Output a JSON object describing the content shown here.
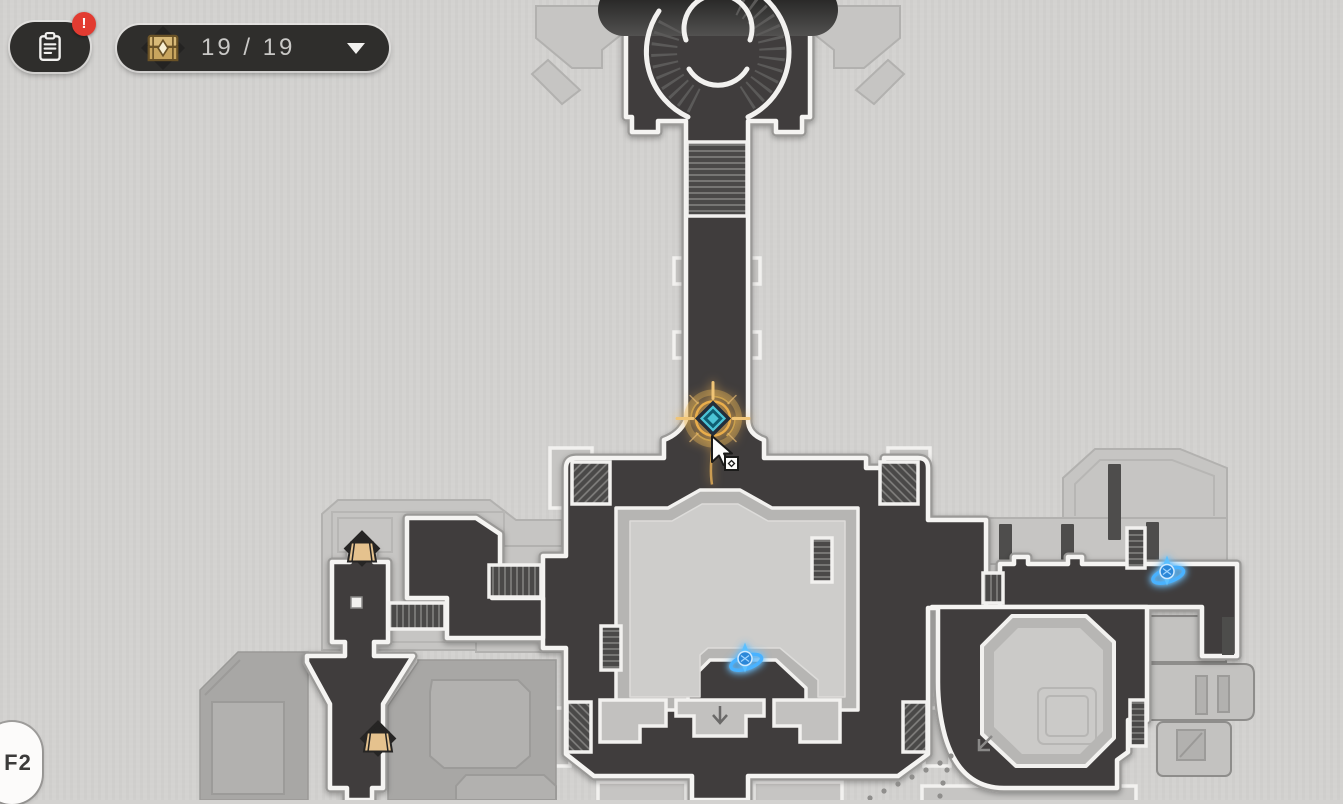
{
  "hud": {
    "tasks_button": {
      "icon": "clipboard-icon",
      "badge": "!"
    },
    "chest_counter": {
      "icon": "treasure-chest-icon",
      "count": "19 / 19",
      "caret_icon": "caret-down-icon"
    },
    "floor_indicator": {
      "label": "F2"
    }
  },
  "map": {
    "markers": [
      {
        "type": "player",
        "name": "player-position-marker",
        "x": 713,
        "y": 421
      },
      {
        "type": "cursor",
        "name": "mouse-cursor",
        "x": 712,
        "y": 437
      },
      {
        "type": "anchor",
        "name": "space-anchor-icon",
        "x": 745,
        "y": 661
      },
      {
        "type": "anchor",
        "name": "space-anchor-icon",
        "x": 1167,
        "y": 574
      },
      {
        "type": "bag",
        "name": "shop-bag-icon",
        "x": 362,
        "y": 551
      },
      {
        "type": "bag",
        "name": "shop-bag-icon",
        "x": 378,
        "y": 741
      }
    ],
    "colors": {
      "background": "#d3d2d0",
      "room_dark": "#3f3e3d",
      "room_border": "#f5f4f2",
      "platform_light": "#c6c5c3",
      "platform_medium": "#a8a7a5",
      "anchor_blue": "#3fa8f5",
      "player_teal": "#4cc4d6",
      "player_gold": "#e9ad4b",
      "chest_gold": "#d8b977",
      "badge_red": "#e23b31",
      "hud_dark": "#2f2e2c"
    }
  }
}
